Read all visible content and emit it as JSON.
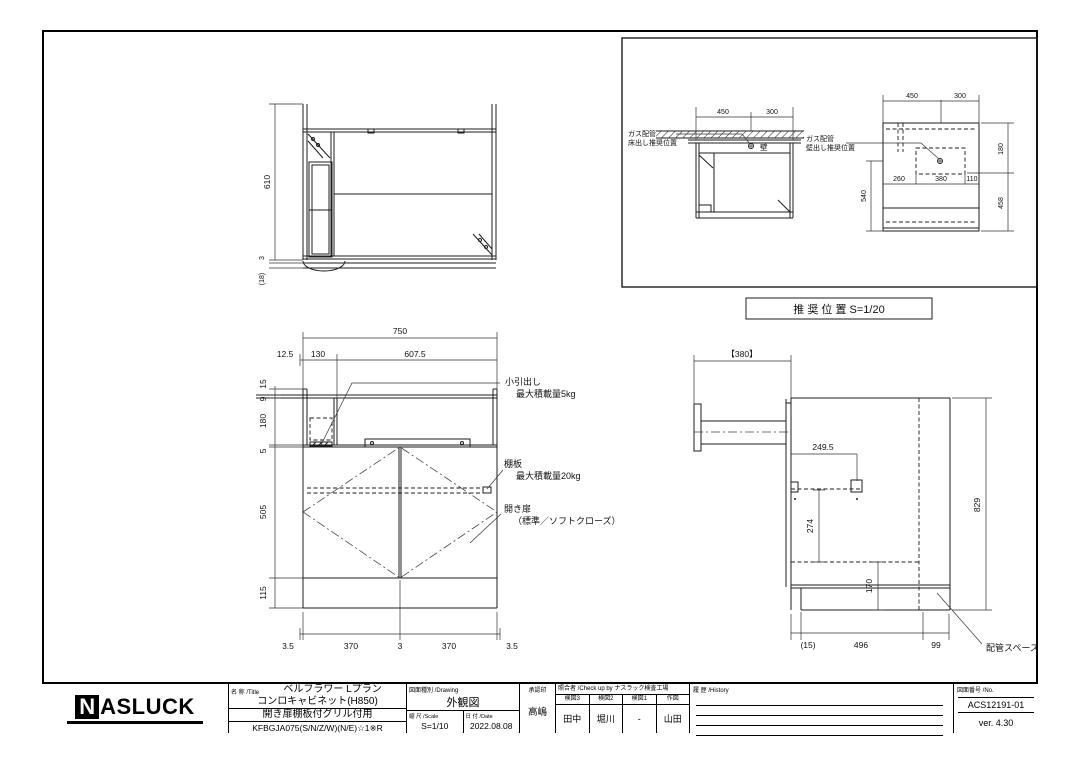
{
  "drawing": {
    "plan": {
      "d610": "610",
      "d3": "3",
      "d18": "(18)"
    },
    "front": {
      "w750": "750",
      "w125": "12.5",
      "w130": "130",
      "w6075": "607.5",
      "h15": "15",
      "h9": "9",
      "h180": "180",
      "h5": "5",
      "h505": "505",
      "h115": "115",
      "b35a": "3.5",
      "b370a": "370",
      "b3": "3",
      "b370b": "370",
      "b35b": "3.5",
      "drawer1": "小引出し",
      "drawer2": "最大積載量5kg",
      "shelf1": "棚板",
      "shelf2": "最大積載量20kg",
      "door1": "開き扉",
      "door2": "（標準／ソフトクローズ）"
    },
    "side": {
      "w380": "【380】",
      "d2495": "249.5",
      "d274": "274",
      "d170": "170",
      "h829": "829",
      "b15": "(15)",
      "b496": "496",
      "b99": "99",
      "pipe": "配管スペース"
    },
    "reco": {
      "caption": "推 奨 位 置  S=1/20",
      "floor1": "ガス配管",
      "floor2": "床出し推奨位置",
      "wall_char": "壁",
      "wall1": "ガス配管",
      "wall2": "壁出し推奨位置",
      "la450": "450",
      "la300": "300",
      "rb450": "450",
      "rb300": "300",
      "rb260": "260",
      "rb380": "380",
      "rb110": "110",
      "rb180": "180",
      "rb458": "458",
      "rb540": "540"
    }
  },
  "title_block": {
    "logo_n": "N",
    "logo_rest": "ASLUCK",
    "name_label": "名 称 /Title",
    "name1": "ベルフラワー Lプラン",
    "name2": "コンロキャビネット(H850)",
    "name3": "開き扉棚板付グリル付用",
    "name4": "KFBGJA075(S/N/Z/W)(N/E)☆1※R",
    "drawing_label": "図面種別 /Drawing",
    "drawing_value": "外観図",
    "scale_label": "縮 尺 /Scale",
    "scale_value": "S=1/10",
    "date_label": "日 付 /Date",
    "date_value": "2022.08.08",
    "approval_label": "承認印",
    "approval_value": "高嶋",
    "check_label": "照合者 /Check up by ナスラック検査工場",
    "check_cols": [
      {
        "label": "検図3",
        "value": "田中"
      },
      {
        "label": "検図2",
        "value": "堀川"
      },
      {
        "label": "検図1",
        "value": "-"
      },
      {
        "label": "作図",
        "value": "山田"
      }
    ],
    "history_label": "履 歴 /History",
    "no_label": "図面番号 /No.",
    "no_value": "ACS12191-01",
    "version": "ver. 4.30"
  }
}
